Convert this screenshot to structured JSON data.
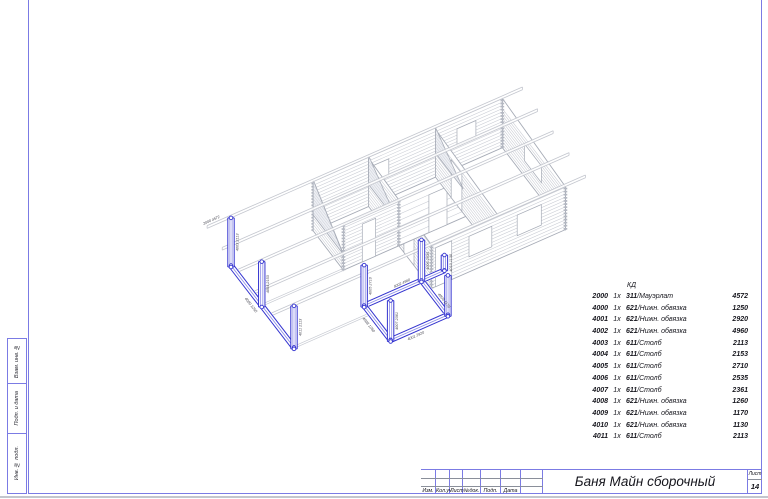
{
  "sheet": {
    "frame_color": "#7b7be4",
    "highlight_color": "#3434d0",
    "structure_color": "#c7cad2"
  },
  "side_stamps": {
    "items": [
      {
        "label": "Взам. инв. №"
      },
      {
        "label": "Подп. и дата"
      },
      {
        "label": "Инв. № подл."
      }
    ]
  },
  "parts_table": {
    "header": "КД",
    "rows": [
      {
        "id": "2000",
        "qty": "1x",
        "code": "311",
        "name": "Мауэрлат",
        "len": "4572"
      },
      {
        "id": "4000",
        "qty": "1x",
        "code": "621",
        "name": "Нижн. обвязка",
        "len": "1250"
      },
      {
        "id": "4001",
        "qty": "1x",
        "code": "621",
        "name": "Нижн. обвязка",
        "len": "2920"
      },
      {
        "id": "4002",
        "qty": "1x",
        "code": "621",
        "name": "Нижн. обвязка",
        "len": "4960"
      },
      {
        "id": "4003",
        "qty": "1x",
        "code": "611",
        "name": "Столб",
        "len": "2113"
      },
      {
        "id": "4004",
        "qty": "1x",
        "code": "611",
        "name": "Столб",
        "len": "2153"
      },
      {
        "id": "4005",
        "qty": "1x",
        "code": "611",
        "name": "Столб",
        "len": "2710"
      },
      {
        "id": "4006",
        "qty": "1x",
        "code": "611",
        "name": "Столб",
        "len": "2535"
      },
      {
        "id": "4007",
        "qty": "1x",
        "code": "611",
        "name": "Столб",
        "len": "2361"
      },
      {
        "id": "4008",
        "qty": "1x",
        "code": "621",
        "name": "Нижн. обвязка",
        "len": "1260"
      },
      {
        "id": "4009",
        "qty": "1x",
        "code": "621",
        "name": "Нижн. обвязка",
        "len": "1170"
      },
      {
        "id": "4010",
        "qty": "1x",
        "code": "621",
        "name": "Нижн. обвязка",
        "len": "1130"
      },
      {
        "id": "4011",
        "qty": "1x",
        "code": "611",
        "name": "Столб",
        "len": "2113"
      }
    ]
  },
  "title_block": {
    "title": "Баня Майн сборочный",
    "sheet_label": "Лист",
    "sheet_number": "14",
    "columns": [
      "Изм.",
      "Кол.уч",
      "Лист",
      "№док.",
      "Подп.",
      "Дата"
    ]
  }
}
